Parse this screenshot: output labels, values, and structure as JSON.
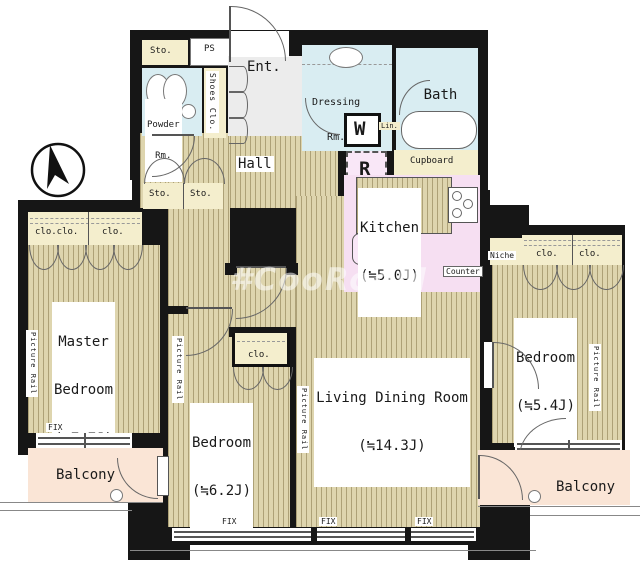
{
  "meta": {
    "watermark": "#CooRooM"
  },
  "colors": {
    "wall": "#161616",
    "floor": "#ded5ae",
    "water_rooms": "#d9edf2",
    "kitchen": "#f6dff2",
    "closet": "#f4eecd",
    "balcony": "#fae5d6",
    "entrance": "#ececec"
  },
  "compass": {
    "name": "north-arrow"
  },
  "top_section": {
    "storage": "Sto.",
    "ps": "PS",
    "powder_room": {
      "line1": "Powder",
      "line2": "Rm."
    },
    "shoes_closet": "Shoes Clo.",
    "entrance": "Ent.",
    "dressing_room": {
      "line1": "Dressing",
      "line2": "Rm."
    },
    "bath": {
      "name": "Bath",
      "size": "(1620)"
    },
    "washer": "W",
    "linen": "Lin.",
    "refrigerator": "R",
    "cupboard": "Cupboard"
  },
  "kitchen": {
    "name": "Kitchen",
    "size": "(≒5.0J)",
    "counter": "Counter"
  },
  "hall": {
    "name": "Hall",
    "storage1": "Sto.",
    "storage2": "Sto."
  },
  "master_bedroom": {
    "line1": "Master",
    "line2": "Bedroom",
    "size": "(≒7.7J)",
    "closet1": "clo.clo.",
    "closet2": "clo.",
    "fix": "FIX",
    "picture_rail": "Picture Rail"
  },
  "bedroom2": {
    "name": "Bedroom",
    "size": "(≒6.2J)",
    "closet": "clo.",
    "picture_rail": "Picture Rail"
  },
  "living": {
    "name": "Living Dining Room",
    "size": "(≒14.3J)",
    "picture_rail": "Picture Rail"
  },
  "bedroom3": {
    "name": "Bedroom",
    "size": "(≒5.4J)",
    "niche": "Niche",
    "closet1": "clo.",
    "closet2": "clo.",
    "picture_rail": "Picture Rail"
  },
  "balconies": {
    "left": "Balcony",
    "right": "Balcony"
  },
  "windows": {
    "fix1": "FIX",
    "fix2": "FIX",
    "fix3": "FIX"
  }
}
